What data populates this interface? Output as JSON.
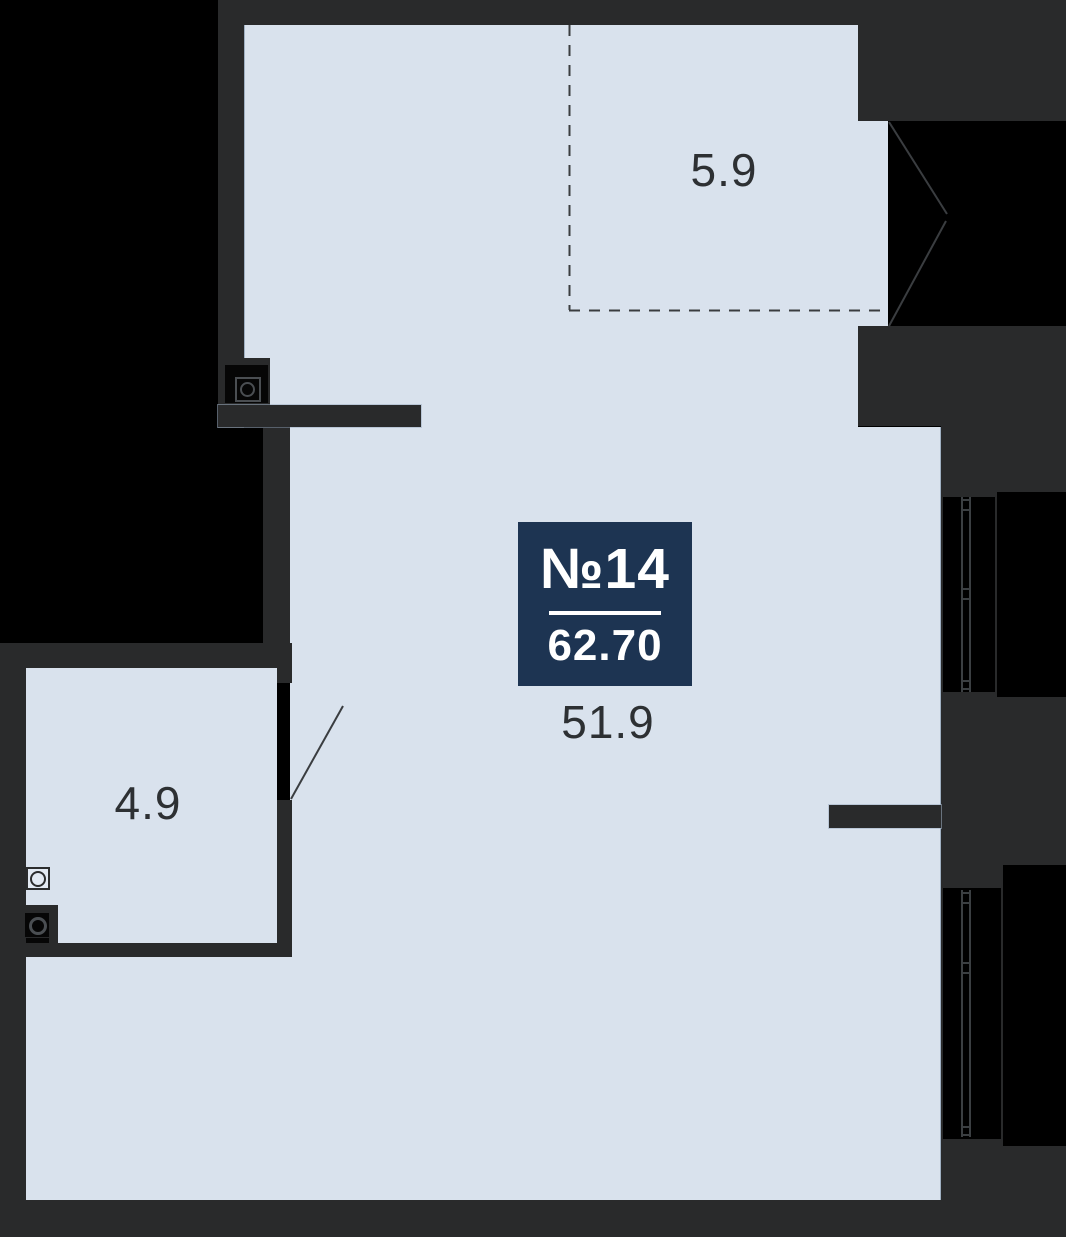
{
  "badge": {
    "unit": "№14",
    "area": "62.70"
  },
  "labels": {
    "balcony": "5.9",
    "living": "51.9",
    "bathroom": "4.9"
  },
  "colors": {
    "outside": "#000000",
    "wall": "#292a2b",
    "floor": "#d9e2ed",
    "badge_bg": "#1d3452",
    "badge_text": "#ffffff",
    "label_text": "#2d3033",
    "line": "#3a3d40"
  }
}
